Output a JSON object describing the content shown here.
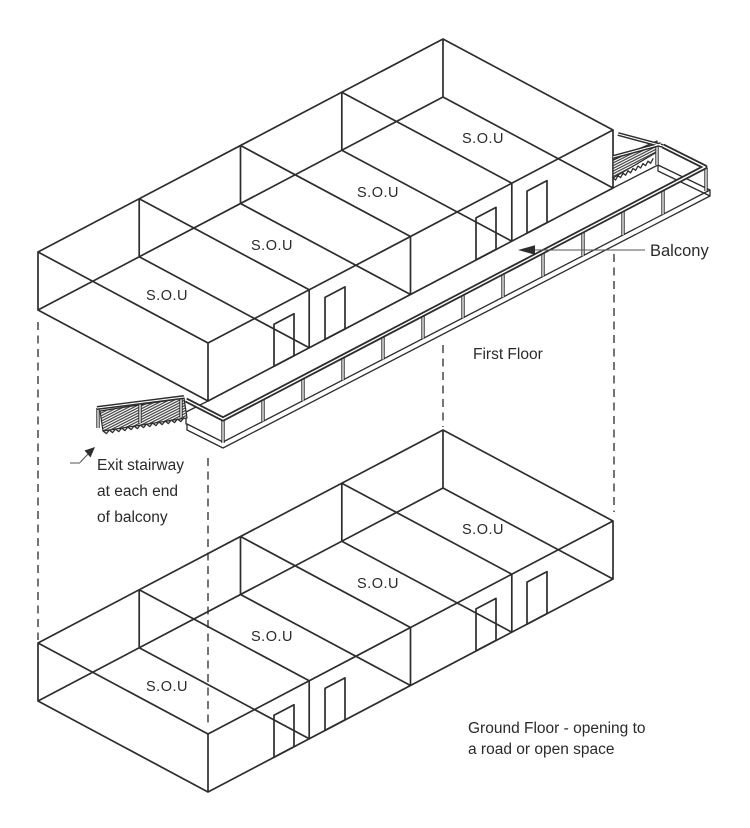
{
  "floors": {
    "first": {
      "caption": "First Floor",
      "units": [
        "S.O.U",
        "S.O.U",
        "S.O.U",
        "S.O.U"
      ]
    },
    "ground": {
      "caption_line1": "Ground Floor - opening to",
      "caption_line2": "a road or open space",
      "units": [
        "S.O.U",
        "S.O.U",
        "S.O.U",
        "S.O.U"
      ]
    }
  },
  "annotations": {
    "balcony": "Balcony",
    "exit_line1": "Exit stairway",
    "exit_line2": "at each end",
    "exit_line3": "of balcony"
  },
  "colors": {
    "ink": "#2d2d2d",
    "background": "#ffffff"
  }
}
